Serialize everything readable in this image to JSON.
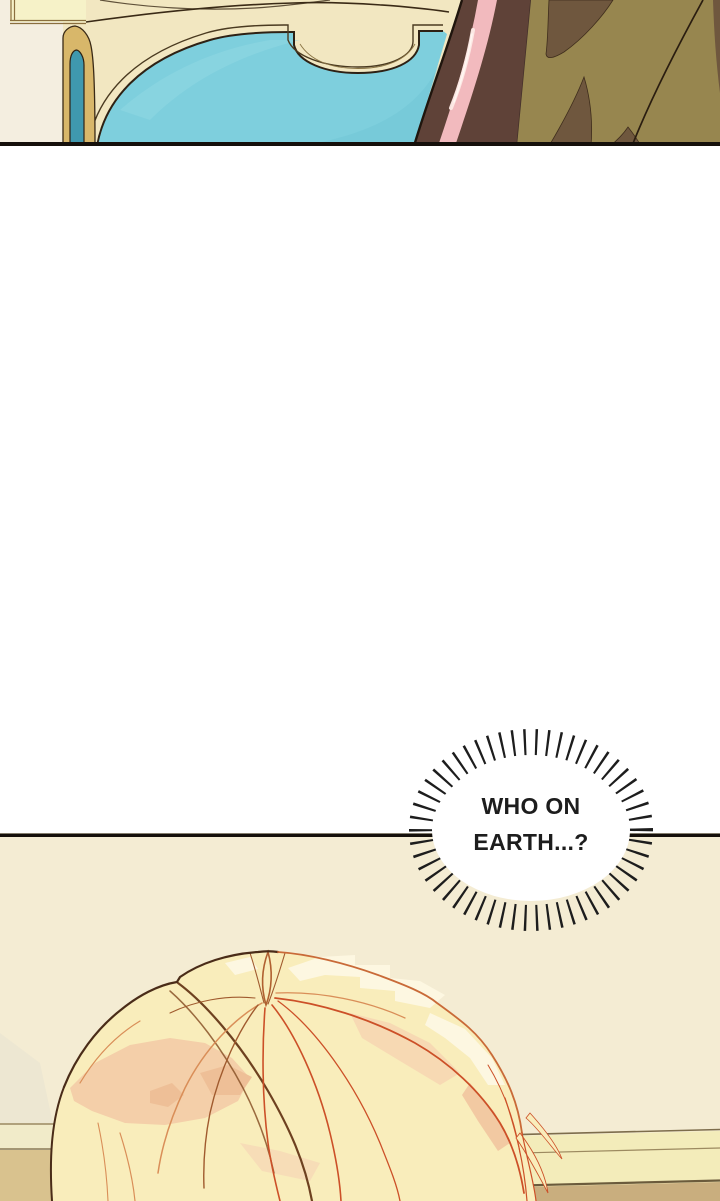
{
  "speech_bubble": {
    "line1": "WHO ON",
    "line2": "EARTH...?",
    "text_color": "#1d1d1d",
    "bubble_fill": "#ffffff",
    "burst_color": "#1d1d1d"
  },
  "palette": {
    "gutter_white": "#ffffff",
    "panel_border_black": "#15100b",
    "headboard_cream": "#f2e7c1",
    "inset_panel_yellow": "#f6f2c8",
    "pillar_white": "#f4eee0",
    "gold_trim": "#d8b76a",
    "niche_teal_dark": "#3f98ae",
    "wall_teal": "#7ecfdd",
    "teal_light_streak": "#95dae5",
    "curtain_brown": "#5f4238",
    "trim_pink": "#f2babe",
    "trim_pink_highlight": "#fdeae6",
    "khaki_olive": "#97864f",
    "khaki_shadow_brown": "#6f573e",
    "outline_dark": "#2e2114",
    "wall_cream": "#f4ecd3",
    "molding_pale_yellow": "#f3ecba",
    "molding_tan": "#c9ae7e",
    "hair_base_blonde": "#f9edbb",
    "hair_highlight": "#fdf7e1",
    "hair_shadow_peach": "#f4cfa9",
    "strand_brown": "#6e4120",
    "strand_orange": "#d98e58",
    "strand_red": "#cc5028"
  }
}
